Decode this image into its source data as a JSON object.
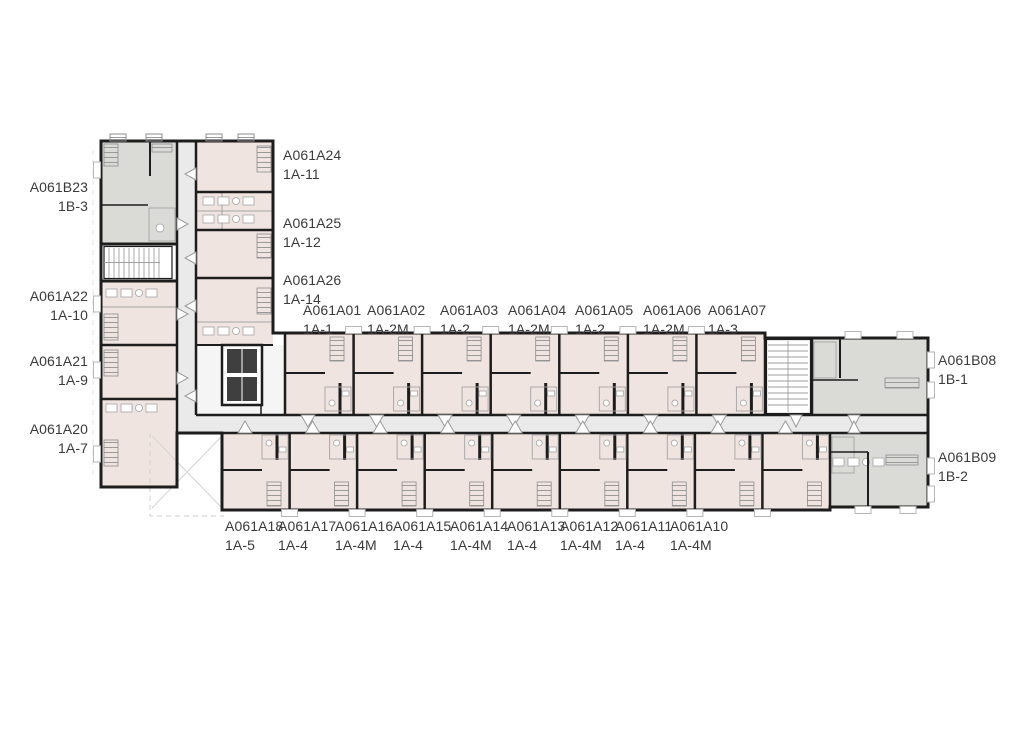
{
  "plan": {
    "colors": {
      "unit_type_a_fill": "#f0e4e1",
      "unit_type_b_fill": "#dadad7",
      "corridor_fill": "#eaeaea",
      "wall": "#1d1d1d",
      "label_text": "#3a3a3a"
    },
    "units": {
      "left_column": [
        {
          "code": "A061B23",
          "type": "1B-3"
        },
        {
          "code": "A061A22",
          "type": "1A-10"
        },
        {
          "code": "A061A21",
          "type": "1A-9"
        },
        {
          "code": "A061A20",
          "type": "1A-7"
        }
      ],
      "top_left_column": [
        {
          "code": "A061A24",
          "type": "1A-11"
        },
        {
          "code": "A061A25",
          "type": "1A-12"
        },
        {
          "code": "A061A26",
          "type": "1A-14"
        }
      ],
      "top_row": [
        {
          "code": "A061A01",
          "type": "1A-1"
        },
        {
          "code": "A061A02",
          "type": "1A-2M"
        },
        {
          "code": "A061A03",
          "type": "1A-2"
        },
        {
          "code": "A061A04",
          "type": "1A-2M"
        },
        {
          "code": "A061A05",
          "type": "1A-2"
        },
        {
          "code": "A061A06",
          "type": "1A-2M"
        },
        {
          "code": "A061A07",
          "type": "1A-3"
        }
      ],
      "right_column": [
        {
          "code": "A061B08",
          "type": "1B-1"
        },
        {
          "code": "A061B09",
          "type": "1B-2"
        }
      ],
      "bottom_row": [
        {
          "code": "A061A18",
          "type": "1A-5"
        },
        {
          "code": "A061A17",
          "type": "1A-4"
        },
        {
          "code": "A061A16",
          "type": "1A-4M"
        },
        {
          "code": "A061A15",
          "type": "1A-4"
        },
        {
          "code": "A061A14",
          "type": "1A-4M"
        },
        {
          "code": "A061A13",
          "type": "1A-4"
        },
        {
          "code": "A061A12",
          "type": "1A-4M"
        },
        {
          "code": "A061A11",
          "type": "1A-4"
        },
        {
          "code": "A061A10",
          "type": "1A-4M"
        }
      ]
    }
  }
}
